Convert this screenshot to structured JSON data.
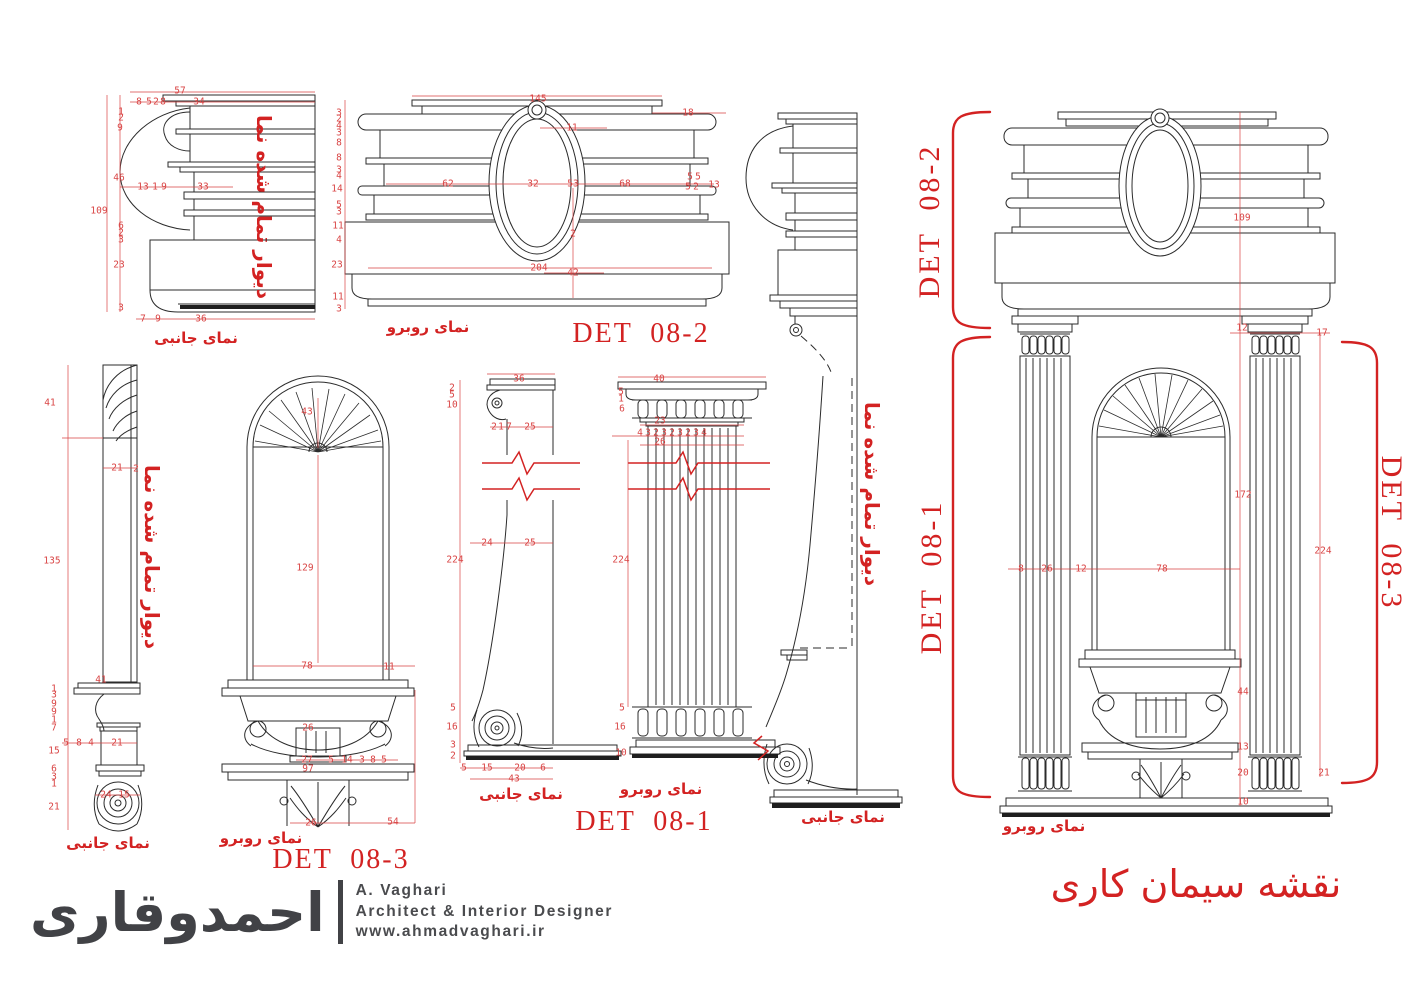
{
  "palette": {
    "red": "#d32222",
    "red_dim": "#d94444",
    "line": "#2b2b2b",
    "logo_gray": "#414246"
  },
  "sheet": {
    "title": "نقشه سیمان کاری"
  },
  "details": [
    "DET  08-1",
    "DET  08-2",
    "DET  08-3"
  ],
  "view_labels": {
    "side": "نمای جانبی",
    "front": "نمای روبرو",
    "wall_note": "دیوار تمام شده نما"
  },
  "logo": {
    "calligraphy": "احمدوقاری",
    "name": "A. Vaghari",
    "role": "Architect & Interior Designer",
    "site": "www.ahmadvaghari.ir"
  },
  "texts": [
    {
      "t": "57",
      "x": 180,
      "y": 91
    },
    {
      "t": "8",
      "x": 139,
      "y": 102
    },
    {
      "t": "5",
      "x": 149,
      "y": 102
    },
    {
      "t": "2",
      "x": 156,
      "y": 102
    },
    {
      "t": "8",
      "x": 163,
      "y": 102
    },
    {
      "t": "34",
      "x": 199,
      "y": 102
    },
    {
      "t": "1",
      "x": 121,
      "y": 112
    },
    {
      "t": "2",
      "x": 121,
      "y": 118
    },
    {
      "t": "9",
      "x": 120,
      "y": 128
    },
    {
      "t": "46",
      "x": 119,
      "y": 178
    },
    {
      "t": "109",
      "x": 99,
      "y": 211
    },
    {
      "t": "13",
      "x": 143,
      "y": 187
    },
    {
      "t": "1",
      "x": 155,
      "y": 187
    },
    {
      "t": "9",
      "x": 164,
      "y": 187
    },
    {
      "t": "33",
      "x": 203,
      "y": 187
    },
    {
      "t": "6",
      "x": 121,
      "y": 226
    },
    {
      "t": "2",
      "x": 121,
      "y": 233
    },
    {
      "t": "3",
      "x": 121,
      "y": 240
    },
    {
      "t": "23",
      "x": 119,
      "y": 265
    },
    {
      "t": "3",
      "x": 121,
      "y": 308
    },
    {
      "t": "7",
      "x": 143,
      "y": 319
    },
    {
      "t": "9",
      "x": 158,
      "y": 319
    },
    {
      "t": "36",
      "x": 201,
      "y": 319
    },
    {
      "t": "نمای جانبی",
      "x": 196,
      "y": 338,
      "c": "cap"
    },
    {
      "t": "دیوار تمام شده نما",
      "x": 264,
      "y": 207,
      "r": 90,
      "c": "wall"
    },
    {
      "t": "145",
      "x": 538,
      "y": 99
    },
    {
      "t": "18",
      "x": 688,
      "y": 113
    },
    {
      "t": "11",
      "x": 572,
      "y": 128
    },
    {
      "t": "3",
      "x": 339,
      "y": 113
    },
    {
      "t": "2",
      "x": 339,
      "y": 119
    },
    {
      "t": "4",
      "x": 339,
      "y": 126
    },
    {
      "t": "3",
      "x": 339,
      "y": 133
    },
    {
      "t": "8",
      "x": 339,
      "y": 143
    },
    {
      "t": "8",
      "x": 339,
      "y": 158
    },
    {
      "t": "3",
      "x": 339,
      "y": 170
    },
    {
      "t": "4",
      "x": 339,
      "y": 176
    },
    {
      "t": "14",
      "x": 337,
      "y": 189
    },
    {
      "t": "5",
      "x": 339,
      "y": 205
    },
    {
      "t": "3",
      "x": 339,
      "y": 212
    },
    {
      "t": "11",
      "x": 338,
      "y": 226
    },
    {
      "t": "4",
      "x": 339,
      "y": 240
    },
    {
      "t": "23",
      "x": 337,
      "y": 265
    },
    {
      "t": "11",
      "x": 338,
      "y": 297
    },
    {
      "t": "3",
      "x": 339,
      "y": 309
    },
    {
      "t": "62",
      "x": 448,
      "y": 184
    },
    {
      "t": "32",
      "x": 533,
      "y": 184
    },
    {
      "t": "53",
      "x": 573,
      "y": 184
    },
    {
      "t": "68",
      "x": 625,
      "y": 184
    },
    {
      "t": "5",
      "x": 690,
      "y": 177
    },
    {
      "t": "5",
      "x": 698,
      "y": 177
    },
    {
      "t": "5",
      "x": 688,
      "y": 187
    },
    {
      "t": "2",
      "x": 696,
      "y": 187
    },
    {
      "t": "13",
      "x": 714,
      "y": 185
    },
    {
      "t": "2",
      "x": 573,
      "y": 234
    },
    {
      "t": "204",
      "x": 539,
      "y": 268
    },
    {
      "t": "42",
      "x": 573,
      "y": 273
    },
    {
      "t": "نمای روبرو",
      "x": 428,
      "y": 327,
      "c": "cap"
    },
    {
      "t": "DET  08-2",
      "x": 641,
      "y": 334,
      "c": "det"
    },
    {
      "t": "109",
      "x": 1242,
      "y": 218
    },
    {
      "t": "12",
      "x": 1242,
      "y": 328
    },
    {
      "t": "17",
      "x": 1322,
      "y": 333
    },
    {
      "t": "172",
      "x": 1243,
      "y": 495
    },
    {
      "t": "224",
      "x": 1323,
      "y": 551
    },
    {
      "t": "8",
      "x": 1021,
      "y": 569
    },
    {
      "t": "26",
      "x": 1047,
      "y": 569
    },
    {
      "t": "12",
      "x": 1081,
      "y": 569
    },
    {
      "t": "78",
      "x": 1162,
      "y": 569
    },
    {
      "t": "44",
      "x": 1243,
      "y": 692
    },
    {
      "t": "13",
      "x": 1243,
      "y": 747
    },
    {
      "t": "20",
      "x": 1243,
      "y": 773
    },
    {
      "t": "21",
      "x": 1324,
      "y": 773
    },
    {
      "t": "10",
      "x": 1243,
      "y": 802
    },
    {
      "t": "نمای روبرو",
      "x": 1044,
      "y": 826,
      "c": "cap"
    },
    {
      "t": "DET  08-2",
      "x": 930,
      "y": 221,
      "r": -90,
      "c": "detr"
    },
    {
      "t": "DET  08-1",
      "x": 932,
      "y": 577,
      "r": -90,
      "c": "detr"
    },
    {
      "t": "DET  08-3",
      "x": 1391,
      "y": 533,
      "r": 90,
      "c": "detr"
    },
    {
      "t": "نقشه سیمان کاری",
      "x": 1196,
      "y": 884,
      "c": "title"
    },
    {
      "t": "41",
      "x": 50,
      "y": 403
    },
    {
      "t": "135",
      "x": 52,
      "y": 561
    },
    {
      "t": "21",
      "x": 117,
      "y": 468
    },
    {
      "t": "2",
      "x": 136,
      "y": 469
    },
    {
      "t": "41",
      "x": 101,
      "y": 680
    },
    {
      "t": "1",
      "x": 54,
      "y": 689
    },
    {
      "t": "3",
      "x": 54,
      "y": 695
    },
    {
      "t": "9",
      "x": 54,
      "y": 704
    },
    {
      "t": "9",
      "x": 54,
      "y": 712
    },
    {
      "t": "1",
      "x": 54,
      "y": 720
    },
    {
      "t": "7",
      "x": 54,
      "y": 728
    },
    {
      "t": "15",
      "x": 54,
      "y": 751
    },
    {
      "t": "6",
      "x": 54,
      "y": 769
    },
    {
      "t": "3",
      "x": 54,
      "y": 777
    },
    {
      "t": "1",
      "x": 54,
      "y": 784
    },
    {
      "t": "21",
      "x": 54,
      "y": 807
    },
    {
      "t": "5",
      "x": 66,
      "y": 743
    },
    {
      "t": "8",
      "x": 79,
      "y": 743
    },
    {
      "t": "4",
      "x": 91,
      "y": 743
    },
    {
      "t": "21",
      "x": 117,
      "y": 743
    },
    {
      "t": "24",
      "x": 106,
      "y": 795
    },
    {
      "t": "15",
      "x": 124,
      "y": 795
    },
    {
      "t": "نمای جانبی",
      "x": 108,
      "y": 843,
      "c": "cap"
    },
    {
      "t": "دیوار تمام شده نما",
      "x": 152,
      "y": 557,
      "r": 90,
      "c": "wall"
    },
    {
      "t": "43",
      "x": 307,
      "y": 412
    },
    {
      "t": "129",
      "x": 305,
      "y": 568
    },
    {
      "t": "78",
      "x": 307,
      "y": 666
    },
    {
      "t": "11",
      "x": 389,
      "y": 667
    },
    {
      "t": "26",
      "x": 308,
      "y": 728
    },
    {
      "t": "27",
      "x": 307,
      "y": 760
    },
    {
      "t": "5",
      "x": 331,
      "y": 760
    },
    {
      "t": "14",
      "x": 347,
      "y": 760
    },
    {
      "t": "3",
      "x": 362,
      "y": 760
    },
    {
      "t": "8",
      "x": 373,
      "y": 760
    },
    {
      "t": "5",
      "x": 384,
      "y": 760
    },
    {
      "t": "97",
      "x": 308,
      "y": 769
    },
    {
      "t": "26",
      "x": 311,
      "y": 823
    },
    {
      "t": "54",
      "x": 393,
      "y": 822
    },
    {
      "t": "نمای روبرو",
      "x": 261,
      "y": 838,
      "c": "cap"
    },
    {
      "t": "DET  08-3",
      "x": 341,
      "y": 860,
      "c": "det"
    },
    {
      "t": "36",
      "x": 519,
      "y": 379
    },
    {
      "t": "2",
      "x": 452,
      "y": 388
    },
    {
      "t": "5",
      "x": 452,
      "y": 395
    },
    {
      "t": "10",
      "x": 452,
      "y": 405
    },
    {
      "t": "2",
      "x": 494,
      "y": 427
    },
    {
      "t": "1",
      "x": 501,
      "y": 427
    },
    {
      "t": "7",
      "x": 509,
      "y": 427
    },
    {
      "t": "25",
      "x": 530,
      "y": 427
    },
    {
      "t": "24",
      "x": 487,
      "y": 543
    },
    {
      "t": "25",
      "x": 530,
      "y": 543
    },
    {
      "t": "224",
      "x": 455,
      "y": 560
    },
    {
      "t": "5",
      "x": 453,
      "y": 708
    },
    {
      "t": "16",
      "x": 452,
      "y": 727
    },
    {
      "t": "3",
      "x": 453,
      "y": 745
    },
    {
      "t": "2",
      "x": 453,
      "y": 756
    },
    {
      "t": "5",
      "x": 464,
      "y": 768
    },
    {
      "t": "15",
      "x": 487,
      "y": 768
    },
    {
      "t": "20",
      "x": 520,
      "y": 768
    },
    {
      "t": "6",
      "x": 543,
      "y": 768
    },
    {
      "t": "43",
      "x": 514,
      "y": 779
    },
    {
      "t": "نمای جانبی",
      "x": 521,
      "y": 794,
      "c": "cap"
    },
    {
      "t": "40",
      "x": 659,
      "y": 379
    },
    {
      "t": "5",
      "x": 621,
      "y": 392
    },
    {
      "t": "1",
      "x": 621,
      "y": 399
    },
    {
      "t": "6",
      "x": 622,
      "y": 409
    },
    {
      "t": "23",
      "x": 660,
      "y": 421
    },
    {
      "t": "4",
      "x": 640,
      "y": 433
    },
    {
      "t": "3",
      "x": 648,
      "y": 433
    },
    {
      "t": "2",
      "x": 656,
      "y": 433
    },
    {
      "t": "3",
      "x": 664,
      "y": 433
    },
    {
      "t": "2",
      "x": 672,
      "y": 433
    },
    {
      "t": "3",
      "x": 680,
      "y": 433
    },
    {
      "t": "2",
      "x": 688,
      "y": 433
    },
    {
      "t": "3",
      "x": 696,
      "y": 433
    },
    {
      "t": "4",
      "x": 704,
      "y": 433
    },
    {
      "t": "26",
      "x": 660,
      "y": 442
    },
    {
      "t": "224",
      "x": 621,
      "y": 560
    },
    {
      "t": "5",
      "x": 622,
      "y": 708
    },
    {
      "t": "16",
      "x": 620,
      "y": 727
    },
    {
      "t": "10",
      "x": 621,
      "y": 753
    },
    {
      "t": "نمای روبرو",
      "x": 661,
      "y": 789,
      "c": "cap"
    },
    {
      "t": "DET  08-1",
      "x": 644,
      "y": 822,
      "c": "det"
    },
    {
      "t": "دیوار تمام شده نما",
      "x": 872,
      "y": 494,
      "r": 90,
      "c": "wall"
    },
    {
      "t": "نمای جانبی",
      "x": 843,
      "y": 817,
      "c": "cap"
    }
  ]
}
